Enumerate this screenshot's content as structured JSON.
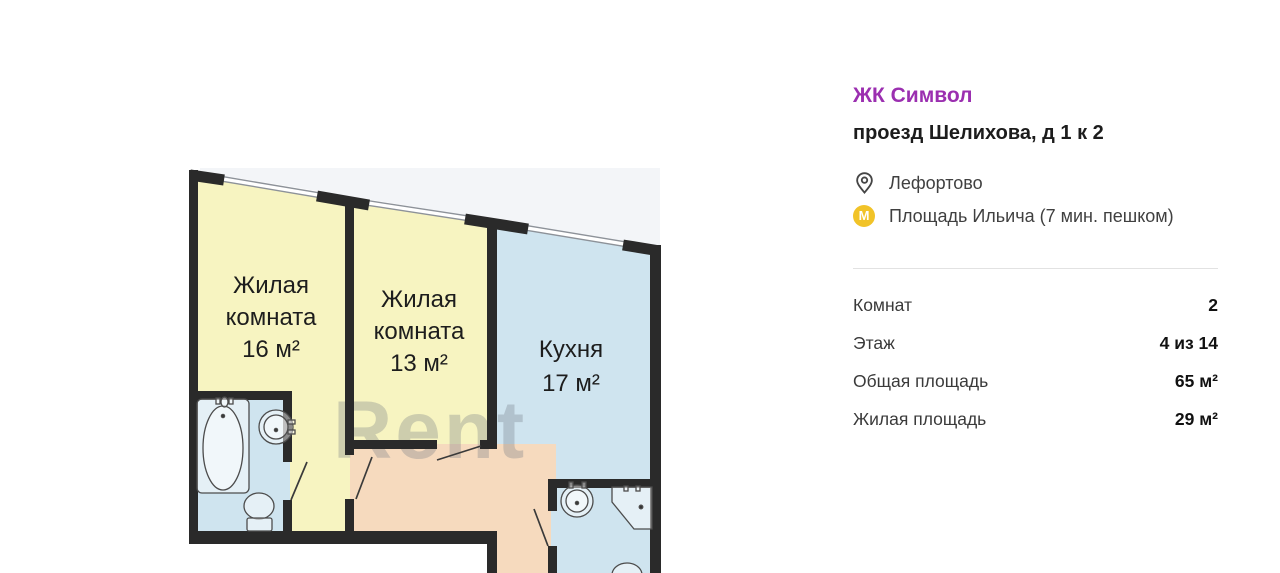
{
  "colors": {
    "accent_purple": "#9b2fb0",
    "metro_yellow": "#f1c328",
    "room_yellow": "#f7f4c1",
    "room_blue": "#cfe4ef",
    "hall_peach": "#f6dabe",
    "wall_dark": "#2a2a2a",
    "window_gray": "#8d9299"
  },
  "listing": {
    "complex_name": "ЖК Символ",
    "address": "проезд Шелихова, д 1 к 2",
    "district": "Лефортово",
    "metro_station": "Площадь Ильича (7 мин. пешком)",
    "metro_icon_letter": "М",
    "params": [
      {
        "label": "Комнат",
        "value": "2"
      },
      {
        "label": "Этаж",
        "value": "4 из 14"
      },
      {
        "label": "Общая площадь",
        "value": "65 м²"
      },
      {
        "label": "Жилая площадь",
        "value": "29 м²"
      }
    ]
  },
  "floorplan": {
    "watermark": "Rent",
    "room1": {
      "lines": [
        "Жилая",
        "комната",
        "16 м²"
      ]
    },
    "room2": {
      "lines": [
        "Жилая",
        "комната",
        "13 м²"
      ]
    },
    "kitchen": {
      "lines": [
        "Кухня",
        "17 м²"
      ]
    }
  }
}
